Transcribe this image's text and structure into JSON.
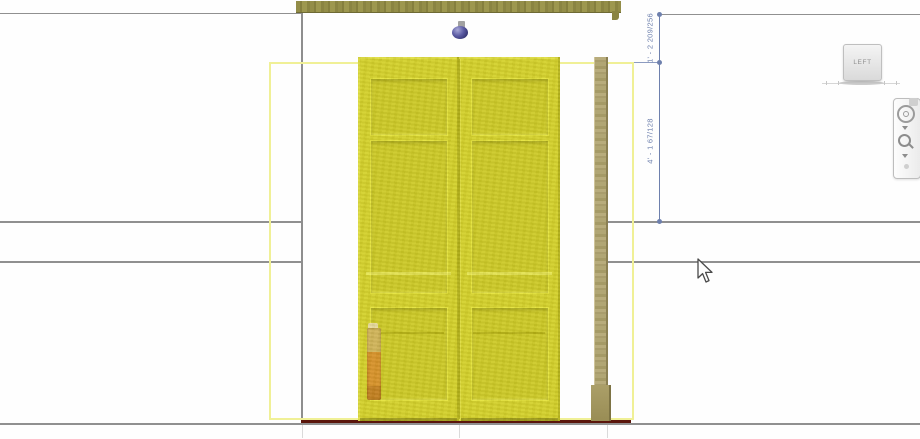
{
  "view": {
    "type": "elevation-view-canvas",
    "selected_element": "double-panel-door"
  },
  "dimensions": {
    "segments": [
      {
        "label": "1' - 2 209/256"
      },
      {
        "label": "4' - 1 67/128"
      }
    ]
  },
  "viewcube": {
    "face_label": "LEFT"
  },
  "navbar": {
    "items": [
      {
        "icon": "steering-wheel-icon"
      },
      {
        "icon": "chevron-down-icon"
      },
      {
        "icon": "zoom-magnifier-icon"
      },
      {
        "icon": "chevron-down-icon"
      }
    ]
  },
  "icons": [
    "viewcube",
    "steering-wheel-icon",
    "zoom-magnifier-icon",
    "chevron-down-icon",
    "cursor-pointer",
    "knob-fixture"
  ],
  "colors": {
    "selection-yellow": "#d2cf2d",
    "selection-outline": "#f0f096",
    "dim-blue": "#6e80ad",
    "sill-red": "#5a150b",
    "line-gray": "#909090",
    "jamb-tan": "#b3a778",
    "header-olive": "#8f8a46",
    "viewcube-text": "#8f8f8f"
  }
}
